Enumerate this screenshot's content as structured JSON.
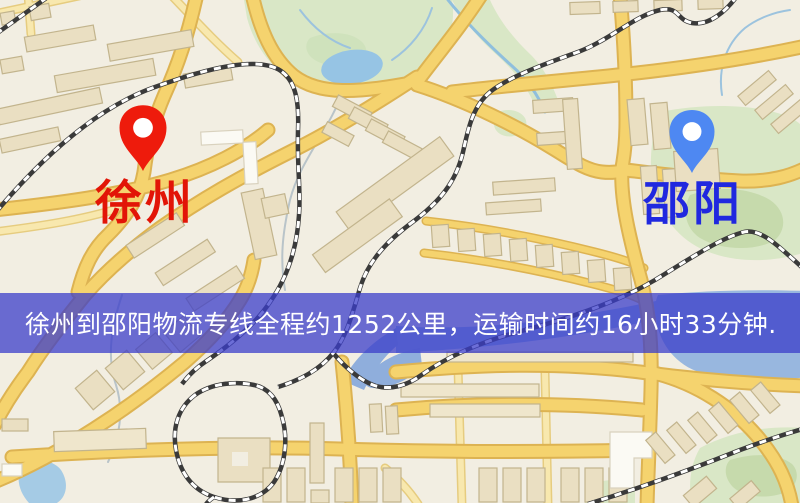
{
  "map": {
    "origin": {
      "name": "徐州",
      "pin_color": "#EE1B0C",
      "label_color": "#E21507"
    },
    "destination": {
      "name": "邵阳",
      "pin_color": "#4E88F2",
      "label_color": "#2028DF"
    },
    "banner": {
      "text": "徐州到邵阳物流专线全程约1252公里，运输时间约16小时33分钟.",
      "distance_text": "约1252公里",
      "duration_text": "约16小时33分钟",
      "background_color": "#3B3DCA",
      "text_color": "#FFFFFF"
    },
    "theme_colors": {
      "land": "#F2EEE2",
      "road_major_fill": "#F5D36E",
      "road_casing": "#DDB352",
      "road_minor_fill": "#F8E8AE",
      "building_tan": "#EADFC2",
      "building_white": "#FBFAF4",
      "park_green": "#D9E7C6",
      "park_green_dark": "#C6DAAC",
      "water_blue": "#9DC4E5",
      "river_blue": "#98B7DF",
      "railway_dark": "#3A3A3A"
    }
  }
}
